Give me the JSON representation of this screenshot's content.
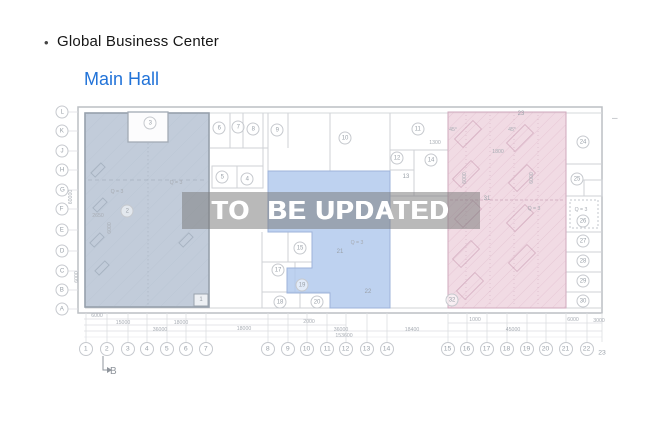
{
  "header": {
    "bullet": "•",
    "title": "Global Business Center",
    "subtitle": "Main Hall"
  },
  "watermark": "TO  BE UPDATED",
  "colors": {
    "subtitle": "#2273d8",
    "left_region": "#b7c3d3",
    "middle_region": "#aec7ec",
    "right_region": "#eed2dd"
  },
  "plan": {
    "row_axis": [
      {
        "label": "L",
        "y": 112
      },
      {
        "label": "K",
        "y": 131
      },
      {
        "label": "J",
        "y": 151
      },
      {
        "label": "H",
        "y": 170
      },
      {
        "label": "G",
        "y": 190
      },
      {
        "label": "F",
        "y": 209
      },
      {
        "label": "E",
        "y": 230
      },
      {
        "label": "D",
        "y": 251
      },
      {
        "label": "C",
        "y": 271
      },
      {
        "label": "B",
        "y": 290
      },
      {
        "label": "A",
        "y": 309
      }
    ],
    "col_axis": [
      {
        "label": "1",
        "x": 86
      },
      {
        "label": "2",
        "x": 107
      },
      {
        "label": "3",
        "x": 128
      },
      {
        "label": "4",
        "x": 147
      },
      {
        "label": "5",
        "x": 167
      },
      {
        "label": "6",
        "x": 186
      },
      {
        "label": "7",
        "x": 206
      },
      {
        "label": "8",
        "x": 268
      },
      {
        "label": "9",
        "x": 288
      },
      {
        "label": "10",
        "x": 307
      },
      {
        "label": "11",
        "x": 327
      },
      {
        "label": "12",
        "x": 346
      },
      {
        "label": "13",
        "x": 367
      },
      {
        "label": "14",
        "x": 387
      },
      {
        "label": "15",
        "x": 448
      },
      {
        "label": "16",
        "x": 467
      },
      {
        "label": "17",
        "x": 487
      },
      {
        "label": "18",
        "x": 507
      },
      {
        "label": "19",
        "x": 527
      },
      {
        "label": "20",
        "x": 546
      },
      {
        "label": "21",
        "x": 566
      },
      {
        "label": "22",
        "x": 587
      },
      {
        "label": "23",
        "x": 602,
        "y": 353,
        "plain": true
      }
    ],
    "rooms": [
      {
        "n": "1",
        "x": 201,
        "y": 300
      },
      {
        "n": "2",
        "x": 127,
        "y": 211,
        "circle": true
      },
      {
        "n": "3",
        "x": 150,
        "y": 123,
        "circle": true
      },
      {
        "n": "4",
        "x": 247,
        "y": 179,
        "circle": true
      },
      {
        "n": "5",
        "x": 222,
        "y": 177,
        "circle": true
      },
      {
        "n": "6",
        "x": 219,
        "y": 128,
        "circle": true
      },
      {
        "n": "7",
        "x": 238,
        "y": 127,
        "circle": true
      },
      {
        "n": "8",
        "x": 253,
        "y": 129,
        "circle": true
      },
      {
        "n": "9",
        "x": 277,
        "y": 130,
        "circle": true
      },
      {
        "n": "10",
        "x": 345,
        "y": 138,
        "circle": true
      },
      {
        "n": "11",
        "x": 418,
        "y": 129,
        "circle": true
      },
      {
        "n": "12",
        "x": 397,
        "y": 158,
        "circle": true
      },
      {
        "n": "13",
        "x": 406,
        "y": 177
      },
      {
        "n": "14",
        "x": 431,
        "y": 160,
        "circle": true
      },
      {
        "n": "15",
        "x": 300,
        "y": 248,
        "circle": true
      },
      {
        "n": "17",
        "x": 278,
        "y": 270,
        "circle": true
      },
      {
        "n": "18",
        "x": 280,
        "y": 302,
        "circle": true
      },
      {
        "n": "19",
        "x": 302,
        "y": 285,
        "circle": true
      },
      {
        "n": "20",
        "x": 317,
        "y": 302,
        "circle": true
      },
      {
        "n": "21",
        "x": 340,
        "y": 252
      },
      {
        "n": "22",
        "x": 368,
        "y": 292
      },
      {
        "n": "23",
        "x": 521,
        "y": 114
      },
      {
        "n": "24",
        "x": 583,
        "y": 142,
        "circle": true
      },
      {
        "n": "25",
        "x": 577,
        "y": 179,
        "circle": true
      },
      {
        "n": "26",
        "x": 583,
        "y": 221,
        "circle": true
      },
      {
        "n": "27",
        "x": 583,
        "y": 241,
        "circle": true
      },
      {
        "n": "28",
        "x": 583,
        "y": 261,
        "circle": true
      },
      {
        "n": "29",
        "x": 583,
        "y": 281,
        "circle": true
      },
      {
        "n": "30",
        "x": 583,
        "y": 301,
        "circle": true
      },
      {
        "n": "31",
        "x": 487,
        "y": 199
      },
      {
        "n": "32",
        "x": 452,
        "y": 300,
        "circle": true
      }
    ],
    "annotations": [
      {
        "t": "Q = 3",
        "x": 117,
        "y": 192
      },
      {
        "t": "Q = 3",
        "x": 176,
        "y": 183
      },
      {
        "t": "Q = 3",
        "x": 357,
        "y": 243
      },
      {
        "t": "Q = 3",
        "x": 534,
        "y": 209
      },
      {
        "t": "Q = 3",
        "x": 581,
        "y": 210
      }
    ],
    "dims": [
      {
        "t": "6000",
        "x": 97,
        "y": 316
      },
      {
        "t": "15000",
        "x": 123,
        "y": 323
      },
      {
        "t": "18000",
        "x": 181,
        "y": 323
      },
      {
        "t": "36000",
        "x": 160,
        "y": 330
      },
      {
        "t": "18000",
        "x": 244,
        "y": 329
      },
      {
        "t": "2000",
        "x": 309,
        "y": 322
      },
      {
        "t": "36000",
        "x": 341,
        "y": 330
      },
      {
        "t": "153600",
        "x": 344,
        "y": 336
      },
      {
        "t": "18400",
        "x": 412,
        "y": 330
      },
      {
        "t": "45000",
        "x": 513,
        "y": 330
      },
      {
        "t": "1000",
        "x": 475,
        "y": 320
      },
      {
        "t": "6000",
        "x": 573,
        "y": 320
      },
      {
        "t": "3000",
        "x": 599,
        "y": 321
      },
      {
        "t": "1800",
        "x": 498,
        "y": 152
      },
      {
        "t": "1300",
        "x": 435,
        "y": 143
      },
      {
        "t": "2650",
        "x": 98,
        "y": 216
      },
      {
        "t": "45°",
        "x": 453,
        "y": 130
      },
      {
        "t": "45°",
        "x": 512,
        "y": 130
      },
      {
        "t": "60000",
        "x": 71,
        "y": 197,
        "rot": true
      },
      {
        "t": "6000",
        "x": 77,
        "y": 277,
        "rot": true
      },
      {
        "t": "6000",
        "x": 110,
        "y": 228,
        "rot": true
      },
      {
        "t": "6000",
        "x": 465,
        "y": 178,
        "rot": true
      },
      {
        "t": "6000",
        "x": 532,
        "y": 178,
        "rot": true
      }
    ],
    "marker": {
      "label": "B"
    },
    "misc_dash": "–"
  }
}
